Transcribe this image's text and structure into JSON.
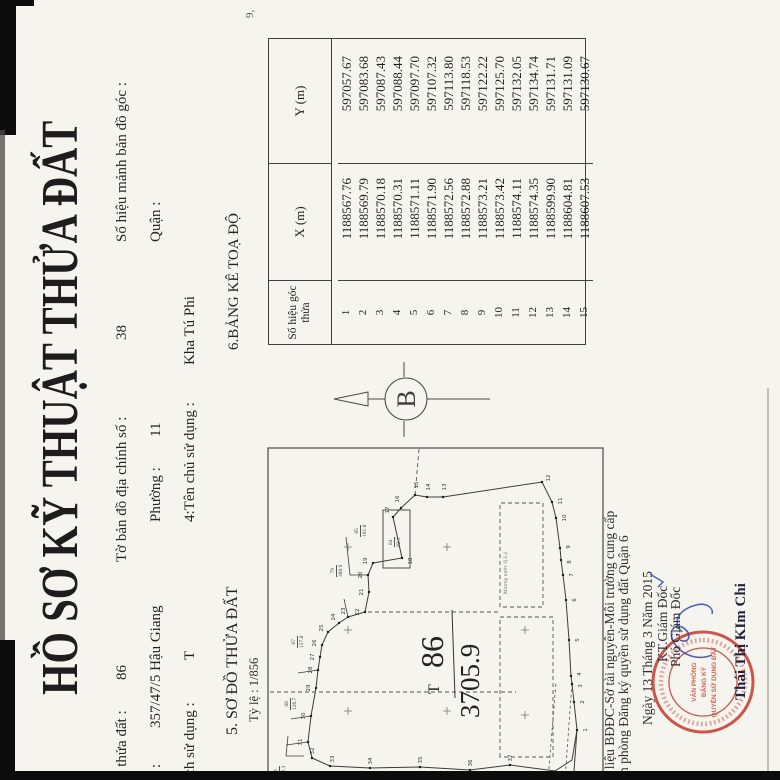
{
  "document": {
    "title": "HỒ SƠ KỸ THUẬT THỬA ĐẤT",
    "header": {
      "parcel_label": "u thửa đất :",
      "parcel_value": "86",
      "sheet_label": "Tờ bản đồ địa chính số :",
      "sheet_value": "38",
      "corner_label": "Số hiệu mảnh bản đồ góc :",
      "addr_label": "í :",
      "addr_value": "357/47/5 Hậu Giang",
      "ward_label": "Phường :",
      "ward_value": "11",
      "district_label": "Quận :",
      "use_label": "ích sử dụng :",
      "use_value": "T",
      "owner_label": "4:Tên chủ sử dụng :",
      "owner_value": "Kha Tú Phi"
    },
    "section_map": {
      "heading": "5. SƠ ĐỒ THỬA ĐẤT",
      "scale": "Tỷ lệ : 1/856"
    },
    "section_table": {
      "heading": "6.BẢNG KÊ TOẠ ĐỘ"
    },
    "table": {
      "col_point": "Số hiệu góc thửa",
      "col_x": "X (m)",
      "col_y": "Y (m)",
      "rows": [
        [
          "1",
          "1188567.76",
          "597057.67"
        ],
        [
          "2",
          "1188569.79",
          "597083.68"
        ],
        [
          "3",
          "1188570.18",
          "597087.43"
        ],
        [
          "4",
          "1188570.31",
          "597088.44"
        ],
        [
          "5",
          "1188571.11",
          "597097.70"
        ],
        [
          "6",
          "1188571.90",
          "597107.32"
        ],
        [
          "7",
          "1188572.56",
          "597113.80"
        ],
        [
          "8",
          "1188572.88",
          "597118.53"
        ],
        [
          "9",
          "1188573.21",
          "597122.22"
        ],
        [
          "10",
          "1188573.42",
          "597125.70"
        ],
        [
          "11",
          "1188574.11",
          "597132.05"
        ],
        [
          "12",
          "1188574.35",
          "597134.74"
        ],
        [
          "13",
          "1188599.90",
          "597131.71"
        ],
        [
          "14",
          "1188604.81",
          "597131.09"
        ],
        [
          "15",
          "1188607.53",
          "597130.67"
        ]
      ]
    },
    "map": {
      "parcel_number": "86",
      "area_value": "3705.9",
      "landuse_mark": "T",
      "north_letter": "B",
      "street_label": "Mương nước Q.Lộ",
      "neighbors": [
        {
          "num": "79",
          "area": "380.9",
          "x": 203,
          "y": 330
        },
        {
          "num": "85",
          "area": "161.8",
          "x": 243,
          "y": 354
        },
        {
          "num": "84",
          "area": "92.1",
          "x": 233,
          "y": 388
        },
        {
          "num": "87",
          "area": "157.8",
          "x": 132,
          "y": 291
        },
        {
          "num": "88",
          "area": "126.7",
          "x": 70,
          "y": 284
        },
        {
          "num": "64",
          "area": "162.3",
          "x": 2,
          "y": 273
        }
      ],
      "vertices": [
        {
          "n": "1",
          "x": 50,
          "y": 577,
          "lx": 50,
          "ly": 587
        },
        {
          "n": "2",
          "x": 78,
          "y": 574,
          "lx": 78,
          "ly": 584
        },
        {
          "n": "3",
          "x": 96,
          "y": 572,
          "lx": 94,
          "ly": 582
        },
        {
          "n": "4",
          "x": 104,
          "y": 571,
          "lx": 106,
          "ly": 581
        },
        {
          "n": "5",
          "x": 140,
          "y": 569,
          "lx": 140,
          "ly": 579
        },
        {
          "n": "6",
          "x": 180,
          "y": 566,
          "lx": 180,
          "ly": 576
        },
        {
          "n": "7",
          "x": 205,
          "y": 563,
          "lx": 205,
          "ly": 573
        },
        {
          "n": "8",
          "x": 220,
          "y": 561,
          "lx": 218,
          "ly": 571
        },
        {
          "n": "9",
          "x": 232,
          "y": 560,
          "lx": 233,
          "ly": 570
        },
        {
          "n": "10",
          "x": 262,
          "y": 556,
          "lx": 262,
          "ly": 566
        },
        {
          "n": "11",
          "x": 278,
          "y": 552,
          "lx": 279,
          "ly": 562
        },
        {
          "n": "12",
          "x": 298,
          "y": 542,
          "lx": 302,
          "ly": 550
        },
        {
          "n": "13",
          "x": 283,
          "y": 443,
          "lx": 293,
          "ly": 446
        },
        {
          "n": "14",
          "x": 283,
          "y": 427,
          "lx": 293,
          "ly": 430
        },
        {
          "n": "15",
          "x": 285,
          "y": 415,
          "lx": 295,
          "ly": 418
        },
        {
          "n": "16",
          "x": 272,
          "y": 401,
          "lx": 281,
          "ly": 399
        },
        {
          "n": "17",
          "x": 263,
          "y": 393,
          "lx": 270,
          "ly": 389
        },
        {
          "n": "18",
          "x": 222,
          "y": 402,
          "lx": 219,
          "ly": 412
        },
        {
          "n": "19",
          "x": 217,
          "y": 373,
          "lx": 219,
          "ly": 367
        },
        {
          "n": "20",
          "x": 205,
          "y": 368,
          "lx": 205,
          "ly": 362
        },
        {
          "n": "21",
          "x": 188,
          "y": 369,
          "lx": 188,
          "ly": 363
        },
        {
          "n": "22",
          "x": 168,
          "y": 365,
          "lx": 168,
          "ly": 359
        },
        {
          "n": "23",
          "x": 163,
          "y": 348,
          "lx": 169,
          "ly": 345
        },
        {
          "n": "24",
          "x": 157,
          "y": 339,
          "lx": 163,
          "ly": 335
        },
        {
          "n": "25",
          "x": 148,
          "y": 328,
          "lx": 152,
          "ly": 323
        },
        {
          "n": "26",
          "x": 135,
          "y": 322,
          "lx": 137,
          "ly": 316
        },
        {
          "n": "27",
          "x": 123,
          "y": 320,
          "lx": 123,
          "ly": 314
        },
        {
          "n": "28",
          "x": 110,
          "y": 318,
          "lx": 110,
          "ly": 312
        },
        {
          "n": "29",
          "x": 92,
          "y": 316,
          "lx": 92,
          "ly": 310
        },
        {
          "n": "30",
          "x": 64,
          "y": 311,
          "lx": 64,
          "ly": 305
        },
        {
          "n": "31",
          "x": 38,
          "y": 308,
          "lx": 38,
          "ly": 302
        },
        {
          "n": "32",
          "x": 22,
          "y": 312,
          "lx": 29,
          "ly": 314
        },
        {
          "n": "33",
          "x": 14,
          "y": 330,
          "lx": 21,
          "ly": 334
        },
        {
          "n": "34",
          "x": 12,
          "y": 370,
          "lx": 19,
          "ly": 372
        },
        {
          "n": "35",
          "x": 13,
          "y": 420,
          "lx": 20,
          "ly": 422
        },
        {
          "n": "36",
          "x": 10,
          "y": 470,
          "lx": 17,
          "ly": 472
        },
        {
          "n": "37",
          "x": 15,
          "y": 510,
          "lx": 22,
          "ly": 512
        }
      ],
      "crosses": [
        [
          69,
          348
        ],
        [
          150,
          348
        ],
        [
          233,
          348
        ],
        [
          69,
          447
        ],
        [
          233,
          447
        ],
        [
          65,
          525
        ],
        [
          150,
          525
        ]
      ]
    },
    "footer": {
      "source1": "ữ liệu BĐĐC-Sở tài nguyên-Môi trường cung cấp",
      "source2": "ăn phòng Đăng ký quyền sử dụng đất Quận 6",
      "date_line": "Ngày  13  Tháng  3  Năm 2015",
      "sign_title1": "KT.Giám Đốc",
      "sign_title2": "Phó Giám Đốc",
      "signer": "Thái Thị KIm Chi",
      "stamp_line1": "VĂN PHÒNG",
      "stamp_line2": "ĐĂNG KÝ",
      "stamp_line3": "QUYỀN SỬ DỤNG ĐẤT"
    },
    "edge_artifact": "9,"
  }
}
